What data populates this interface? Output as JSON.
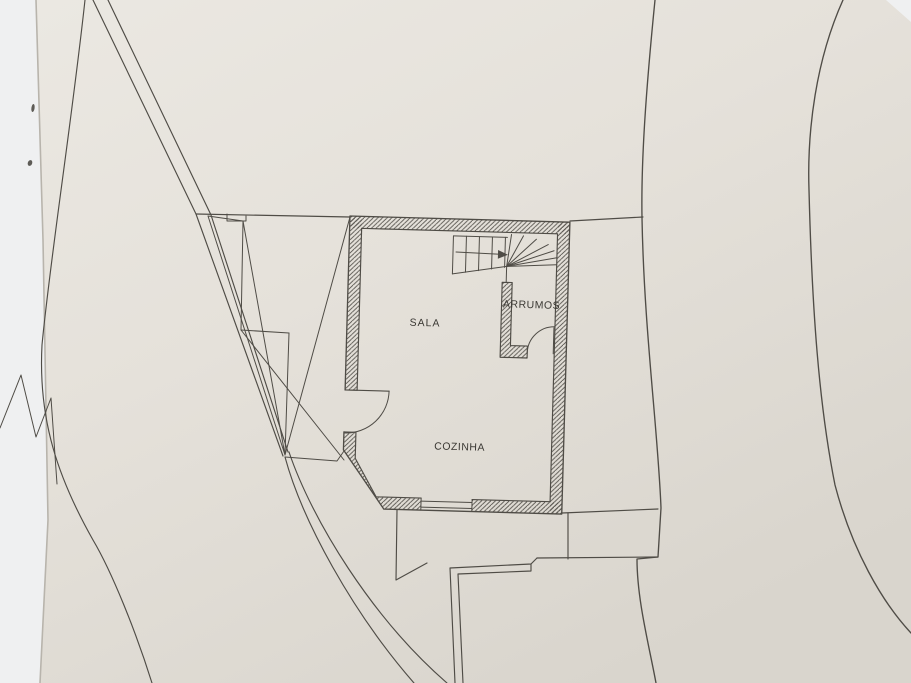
{
  "plan": {
    "rooms": [
      {
        "id": "sala",
        "label": "SALA"
      },
      {
        "id": "cozinha",
        "label": "COZINHA"
      },
      {
        "id": "arrumos",
        "label": "ARRUMOS"
      }
    ]
  },
  "colors": {
    "background": "#eff0f1",
    "paper": "#e5e1da",
    "line": "#4f4c46",
    "hatch": "#55524c",
    "text": "#3a3833",
    "paper_edge": "#b8b4ac"
  }
}
